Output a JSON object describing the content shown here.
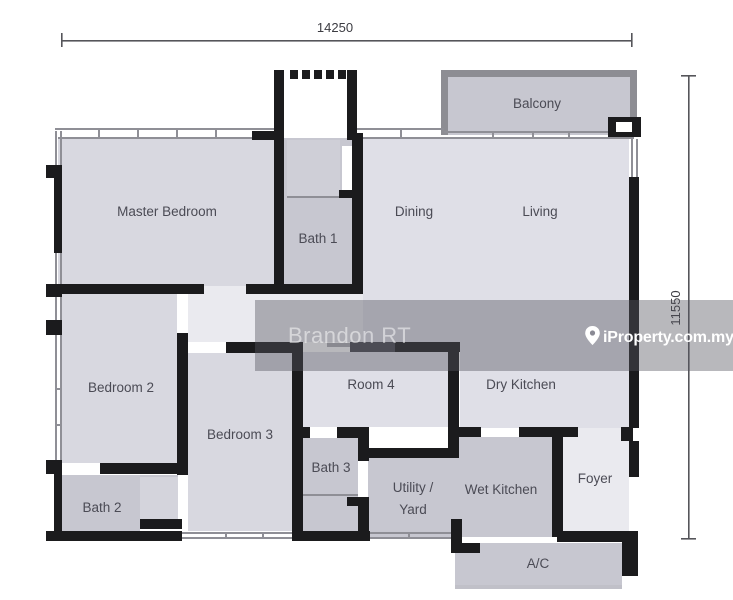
{
  "dimensions": {
    "width_label": "14250",
    "height_label": "11550"
  },
  "rooms": {
    "balcony": "Balcony",
    "master_bedroom": "Master Bedroom",
    "bath_1": "Bath 1",
    "dining": "Dining",
    "living": "Living",
    "bedroom_2": "Bedroom 2",
    "bedroom_3": "Bedroom 3",
    "room_4": "Room 4",
    "dry_kitchen": "Dry Kitchen",
    "bath_2": "Bath 2",
    "bath_3": "Bath 3",
    "utility_yard_line1": "Utility /",
    "utility_yard_line2": "Yard",
    "wet_kitchen": "Wet Kitchen",
    "foyer": "Foyer",
    "ac": "A/C"
  },
  "watermarks": {
    "agent": "Brandon RT",
    "brand": "iProperty.com.my",
    "brand_icon": "location-pin"
  },
  "colors": {
    "wall": "#1b1b1d",
    "room_light": "#d8d8e0",
    "room_medium": "#dfdfe7",
    "room_dark": "#c7c7d0",
    "hallway": "#eaeaef",
    "watermark_band": "#565660",
    "label_text": "#4b4b55"
  }
}
